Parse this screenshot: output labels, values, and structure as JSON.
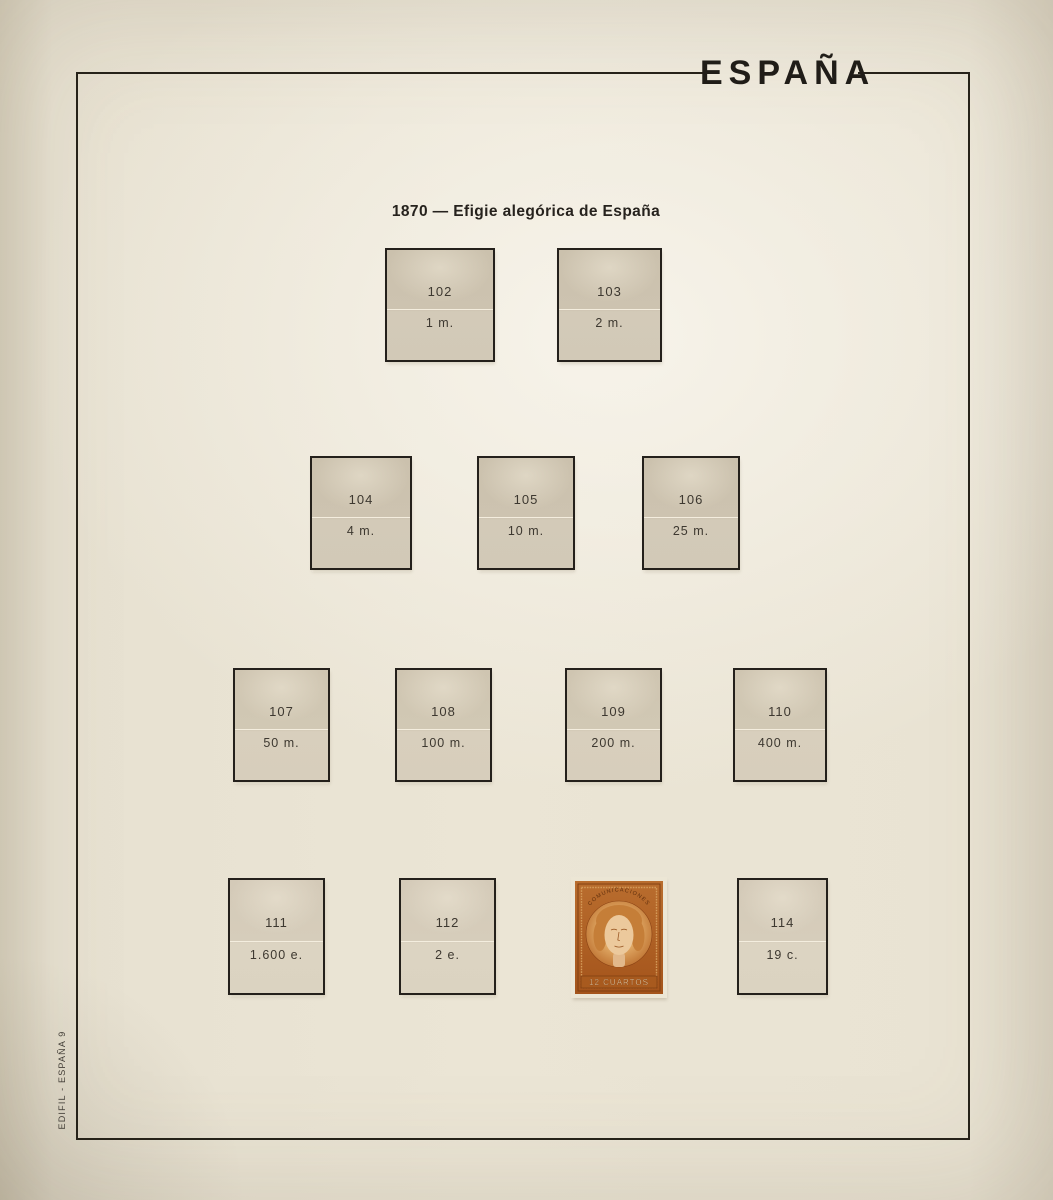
{
  "album": {
    "country_title": "ESPAÑA",
    "series_heading": "1870 — Efigie alegórica de España",
    "publisher_mark": "EDIFIL - ESPAÑA 9"
  },
  "colors": {
    "paper": "#e9e3d3",
    "mount_tan": "#d0c7b4",
    "frame_line": "#262219",
    "stamp_orange": "#b5672a"
  },
  "rows": [
    [
      {
        "number": "102",
        "value": "1 m."
      },
      {
        "number": "103",
        "value": "2 m."
      }
    ],
    [
      {
        "number": "104",
        "value": "4 m."
      },
      {
        "number": "105",
        "value": "10 m."
      },
      {
        "number": "106",
        "value": "25 m."
      }
    ],
    [
      {
        "number": "107",
        "value": "50 m."
      },
      {
        "number": "108",
        "value": "100 m."
      },
      {
        "number": "109",
        "value": "200 m."
      },
      {
        "number": "110",
        "value": "400 m."
      }
    ],
    [
      {
        "number": "111",
        "value": "1.600 e."
      },
      {
        "number": "112",
        "value": "2 e."
      },
      {
        "number": "114",
        "value": "19 c."
      }
    ]
  ],
  "stamp": {
    "top_inscription": "COMUNICACIONES",
    "denomination": "12 CUARTOS"
  }
}
